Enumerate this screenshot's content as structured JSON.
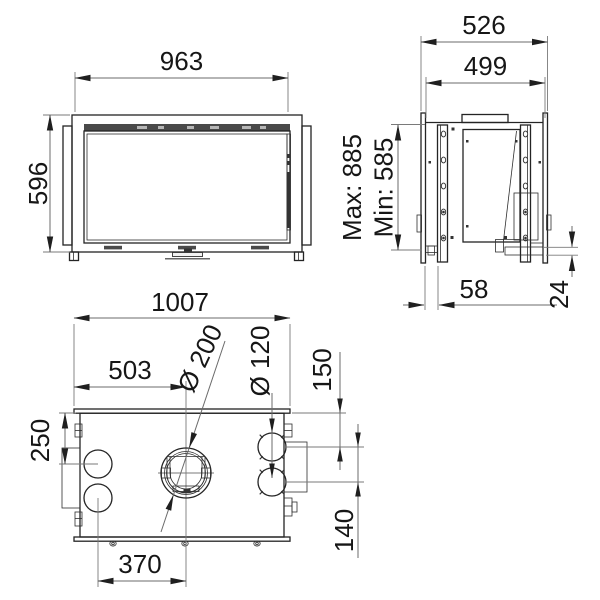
{
  "drawing": {
    "front_view": {
      "width_label": "963",
      "height_label": "596"
    },
    "side_view": {
      "outer_depth_label": "526",
      "inner_depth_label": "499",
      "max_height_label": "Max: 885",
      "min_height_label": "Min: 585",
      "rail_offset_label": "58",
      "bottom_lip_label": "24"
    },
    "top_view": {
      "overall_width_label": "1007",
      "center_offset_label": "503",
      "duct_diameter_label": "Ø 200",
      "port_diameter_label": "Ø 120",
      "top_to_port_label": "150",
      "left_port_offset_label": "250",
      "port_spacing_label": "140",
      "port_to_center_label": "370"
    },
    "colors": {
      "line": "#242424",
      "dimension_line": "#6b6b6b",
      "text": "#161616",
      "background": "#ffffff"
    }
  }
}
